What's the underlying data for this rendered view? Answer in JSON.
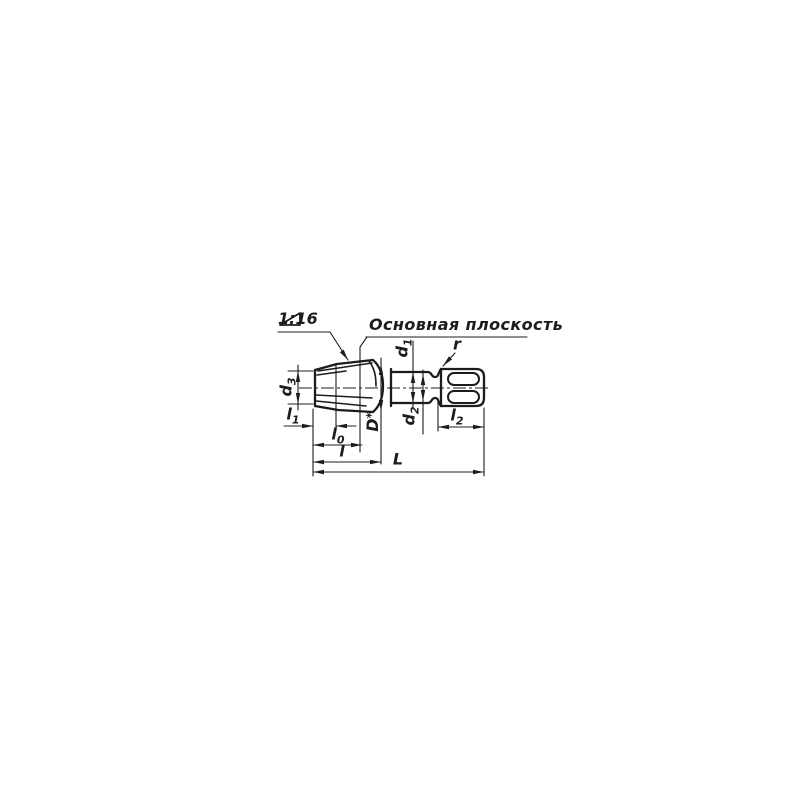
{
  "drawing": {
    "type": "engineering-drawing",
    "subject": "taper tap with square drive shank",
    "colors": {
      "line": "#1c1c1c",
      "background": "#ffffff"
    },
    "annotations": {
      "taper": {
        "symbol": "taper-triangle",
        "text": "1:16"
      },
      "basic_plane": "Основная плоскость"
    },
    "dimensions": {
      "d3": {
        "base": "d",
        "sub": "3"
      },
      "l1": {
        "base": "l",
        "sub": "1"
      },
      "l0": {
        "base": "l",
        "sub": "0"
      },
      "l": {
        "base": "l",
        "sub": ""
      },
      "L": {
        "base": "L",
        "sub": ""
      },
      "D": {
        "base": "D",
        "sup": "*"
      },
      "d1": {
        "base": "d",
        "sub": "1"
      },
      "d2": {
        "base": "d",
        "sub": "2"
      },
      "r": {
        "base": "r",
        "sub": ""
      },
      "l2": {
        "base": "l",
        "sub": "2"
      }
    }
  }
}
